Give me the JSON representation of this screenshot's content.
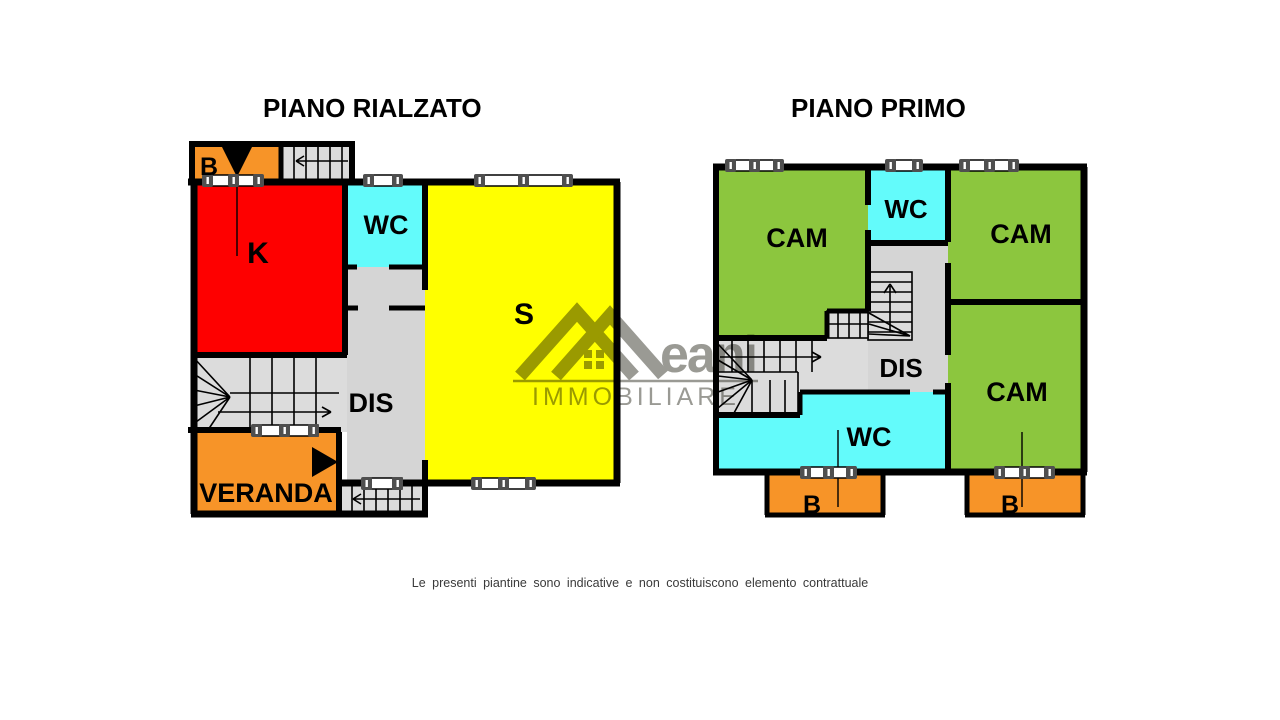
{
  "titles": {
    "left": "PIANO RIALZATO",
    "right": "PIANO PRIMO"
  },
  "plans": {
    "left": {
      "balcony": "B",
      "kitchen": "K",
      "wc": "WC",
      "living": "S",
      "hall": "DIS",
      "veranda": "VERANDA"
    },
    "right": {
      "cam_top_left": "CAM",
      "wc_top": "WC",
      "cam_top_right": "CAM",
      "cam_bottom_right": "CAM",
      "hall": "DIS",
      "wc_bottom": "WC",
      "balcony_left": "B",
      "balcony_right": "B"
    }
  },
  "watermark": {
    "brand": "eani",
    "subtitle": "IMMOBILIARE"
  },
  "disclaimer": "Le presenti piantine sono indicative e non costituiscono elemento contrattuale",
  "colors": {
    "wall": "#000000",
    "kitchen_red": "#fe0000",
    "living_yellow": "#ffff00",
    "wc_cyan": "#63fbfb",
    "bedroom_green": "#8cc63e",
    "balcony_orange": "#f79428",
    "hall_gray": "#d5d5d5",
    "stair_gray": "#dcdcdc",
    "watermark_gray": "#3c3c32"
  }
}
